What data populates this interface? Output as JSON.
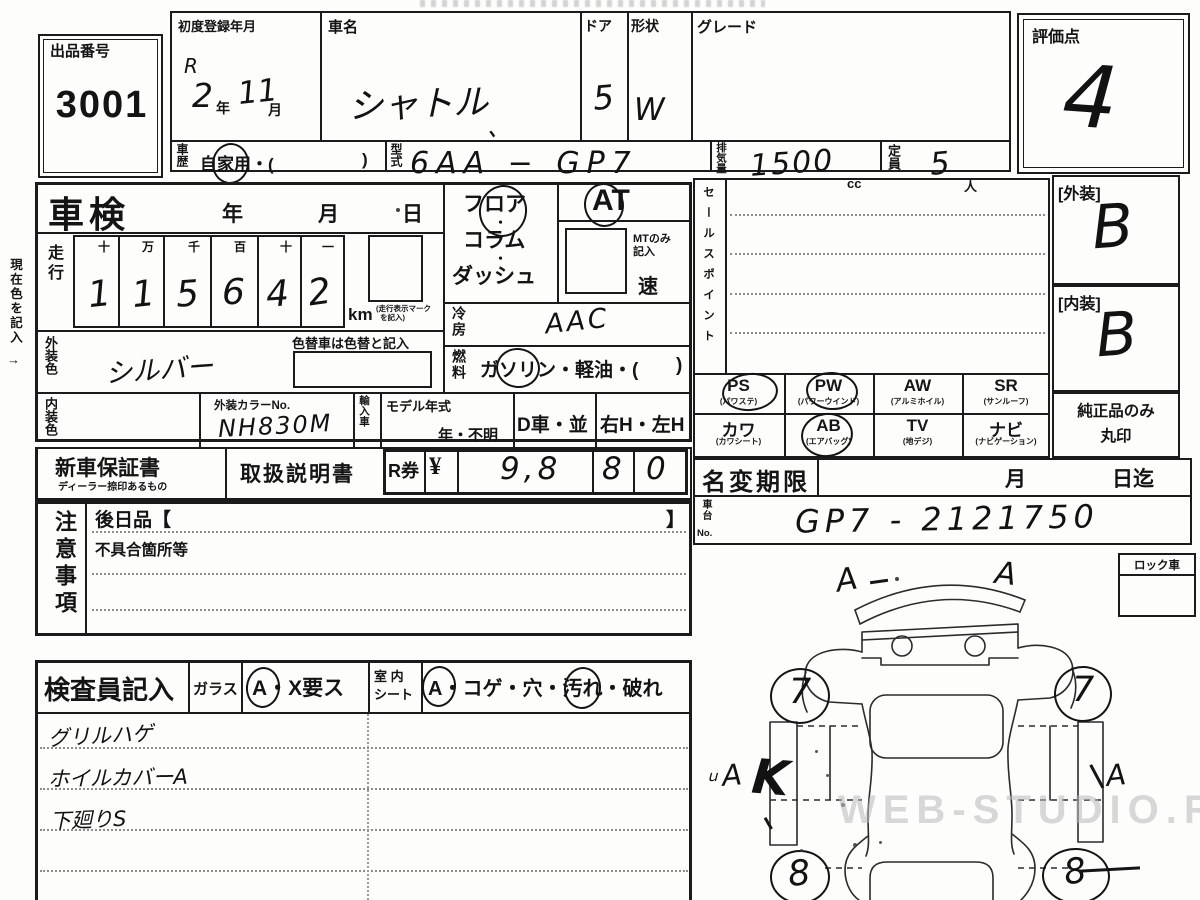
{
  "top": {
    "auction_no_label": "出品番号",
    "auction_no": "3001",
    "first_reg_label": "初度登録年月",
    "first_reg_era": "R",
    "first_reg_year": "2",
    "unit_year": "年",
    "first_reg_month": "11",
    "unit_month": "月",
    "car_name_label": "車名",
    "car_name": "シャトル",
    "pen_mark": "、",
    "door_label": "ドア",
    "door": "5",
    "shape_label": "形状",
    "shape": "W",
    "grade_label": "グレード",
    "history_label": "車歴",
    "history_p1": "自",
    "history_circled": "家",
    "history_p2": "用・(",
    "history_p3": ")",
    "model_label": "型式",
    "model_value": "6AA − GP7",
    "disp_label": "排気量",
    "disp_value": "1500",
    "disp_unit": "cc",
    "cap_label": "定員",
    "cap_value": "5",
    "cap_unit": "人",
    "score_label": "評価点",
    "score": "4"
  },
  "mid": {
    "shaken_label": "車検",
    "u_year": "年",
    "u_month": "月",
    "u_day": "日",
    "mileage_label": "走行",
    "digit_headers": [
      "十",
      "万",
      "千",
      "百",
      "十",
      "一"
    ],
    "digits": [
      "1",
      "1",
      "5",
      "6",
      "4",
      "2"
    ],
    "km": "km",
    "km_note1": "(走行表示マーク",
    "km_note2": "を記入)",
    "ext_color_label": "外装色",
    "ext_color": "シルバー",
    "repaint_note": "色替車は色替と記入",
    "int_color_label": "内装色",
    "color_no_label": "外装カラーNo.",
    "color_no": "NH830M",
    "import_label": "輸入車",
    "model_year_label": "モデル年式",
    "model_year": "年・不明",
    "dealer": "D車・並",
    "handle": "右H・左H",
    "shift_l1": "フロア",
    "shift_dot1": "・",
    "shift_l2": "コラム",
    "shift_dot2": "・",
    "shift_l3": "ダッシュ",
    "at": "AT",
    "mt_note1": "MTのみ",
    "mt_note2": "記入",
    "mt_unit": "速",
    "ac_label": "冷房",
    "ac_value": "AAC",
    "fuel_label": "燃料",
    "fuel_p1": "ガ",
    "fuel_circled": "ソリ",
    "fuel_p2": "ン・軽油・(",
    "fuel_p3": ")"
  },
  "sales": {
    "label": "セールスポイント"
  },
  "equip": {
    "items": [
      {
        "code": "PS",
        "name": "(パワステ)",
        "circled": true
      },
      {
        "code": "PW",
        "name": "(パワーウインド)",
        "circled": true
      },
      {
        "code": "AW",
        "name": "(アルミホイル)",
        "circled": false
      },
      {
        "code": "SR",
        "name": "(サンルーフ)",
        "circled": false
      },
      {
        "code": "カワ",
        "name": "(カワシート)",
        "circled": false
      },
      {
        "code": "AB",
        "name": "(エアバッグ)",
        "circled": true
      },
      {
        "code": "TV",
        "name": "(地デジ)",
        "circled": false
      },
      {
        "code": "ナビ",
        "name": "(ナビゲーション)",
        "circled": false
      }
    ]
  },
  "ratings": {
    "ext_label": "[外装]",
    "ext": "B",
    "int_label": "[内装]",
    "int": "B",
    "genuine1": "純正品のみ",
    "genuine2": "丸印"
  },
  "docs": {
    "warranty": "新車保証書",
    "warranty_sub": "ディーラー捺印あるもの",
    "manual": "取扱説明書",
    "rticket": "R券",
    "yen": "¥",
    "amount1": "9,8",
    "amount2": "8",
    "amount3": "0"
  },
  "transfer": {
    "label": "名変期限",
    "u_month": "月",
    "due": "日迄",
    "chassis_v": "車台",
    "chassis_no_lbl": "No.",
    "chassis": "GP7 - 2121750"
  },
  "caution": {
    "label": "注意事項",
    "later": "後日品【",
    "close": "】",
    "defect": "不具合箇所等"
  },
  "inspector": {
    "label": "検査員記入",
    "glass_label": "ガラス",
    "glass_circled": "A",
    "glass_rest": "・X要ス",
    "seat_label1": "室 内",
    "seat_label2": "シート",
    "seat_circled": "A",
    "seat_p1": "・コゲ・穴・",
    "seat_circled2": "汚",
    "seat_p2": "れ・破れ",
    "notes": [
      "グリルハゲ",
      "ホイルカバーA",
      "下廻りS"
    ]
  },
  "diagram": {
    "lock_label": "ロック車",
    "mark_tl": "A",
    "mark_tr": "A",
    "wheel_fl": "7",
    "wheel_fr": "7",
    "wheel_rl": "8",
    "wheel_rr": "8",
    "mark_left_small": "ｕ",
    "mark_left": "A",
    "mark_left_k": "K",
    "mark_right": "A"
  },
  "misc": {
    "margin_note": "現在色を記入",
    "margin_arrow": "→",
    "watermark": "WEB-STUDIO.RU"
  }
}
